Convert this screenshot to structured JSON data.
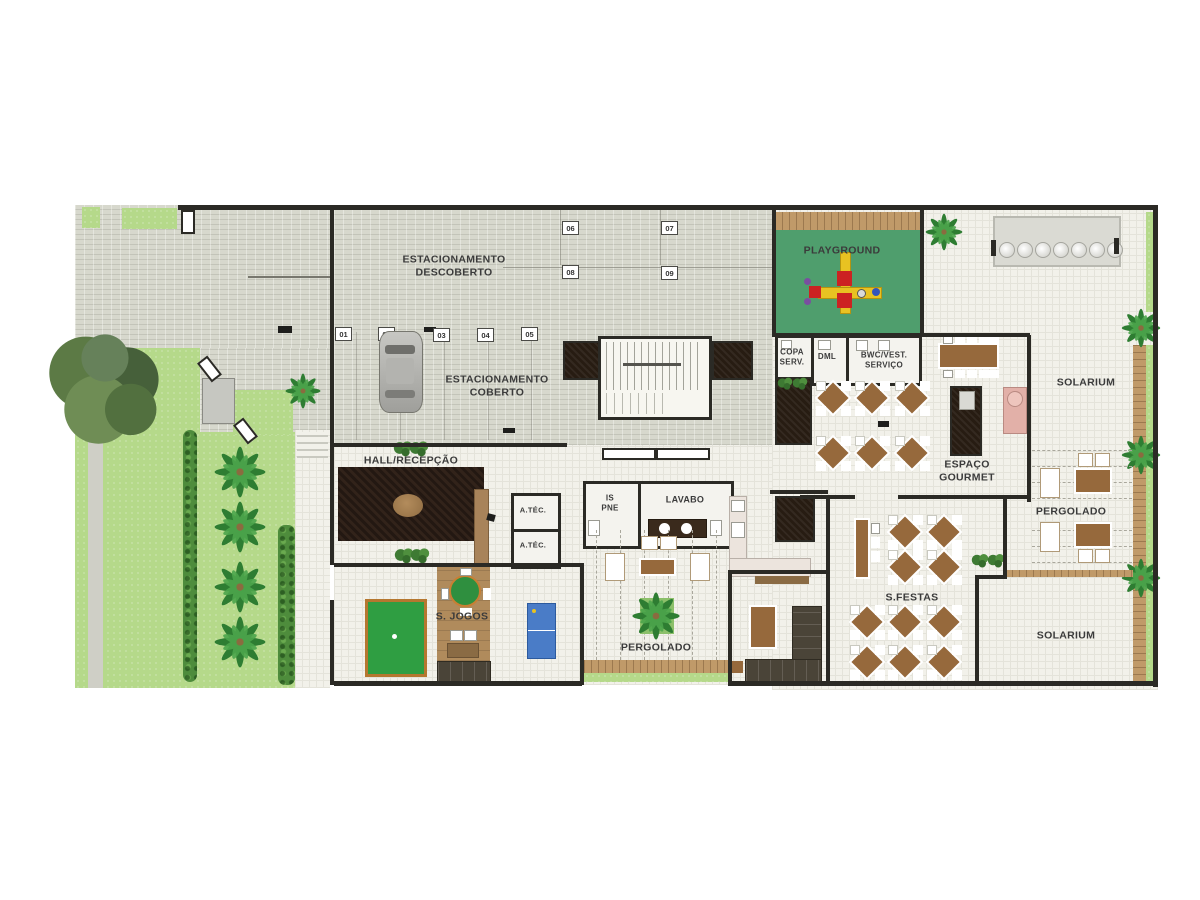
{
  "labels": {
    "estacionamento_descoberto": "ESTACIONAMENTO DESCOBERTO",
    "estacionamento_coberto": "ESTACIONAMENTO COBERTO",
    "playground": "PLAYGROUND",
    "copa_serv": "COPA SERV.",
    "dml": "DML",
    "bwc_vest_servico": "BWC/VEST. SERVIÇO",
    "espaco_gourmet": "ESPAÇO GOURMET",
    "solarium_top": "SOLARIUM",
    "pergolado_right": "PERGOLADO",
    "solarium_bottom": "SOLARIUM",
    "hall_recepcao": "HALL/RECEPÇÃO",
    "a_tec_1": "A.TÉC.",
    "a_tec_2": "A.TÉC.",
    "is_pne": "IS PNE",
    "lavabo": "LAVABO",
    "s_jogos": "S. JOGOS",
    "pergolado_center": "PERGOLADO",
    "s_festas": "S.FESTAS"
  },
  "parking": {
    "spots": [
      "01",
      "02",
      "03",
      "04",
      "05",
      "06",
      "07",
      "08",
      "09"
    ]
  },
  "colors": {
    "wall": "#2b2a25",
    "paver": "#d7d8cd",
    "tile": "#f2f1ea",
    "grass": "#b5d98a",
    "hedge": "#4e8c3c",
    "playground_green": "#4f9e6d",
    "wood_deck": "#c09a69",
    "hall_rug": "#32231a",
    "table_wood": "#96693c",
    "billiards_green": "#2f9e42",
    "ping_pong_blue": "#4a7cc7",
    "grill_pink": "#e2b0a8"
  }
}
